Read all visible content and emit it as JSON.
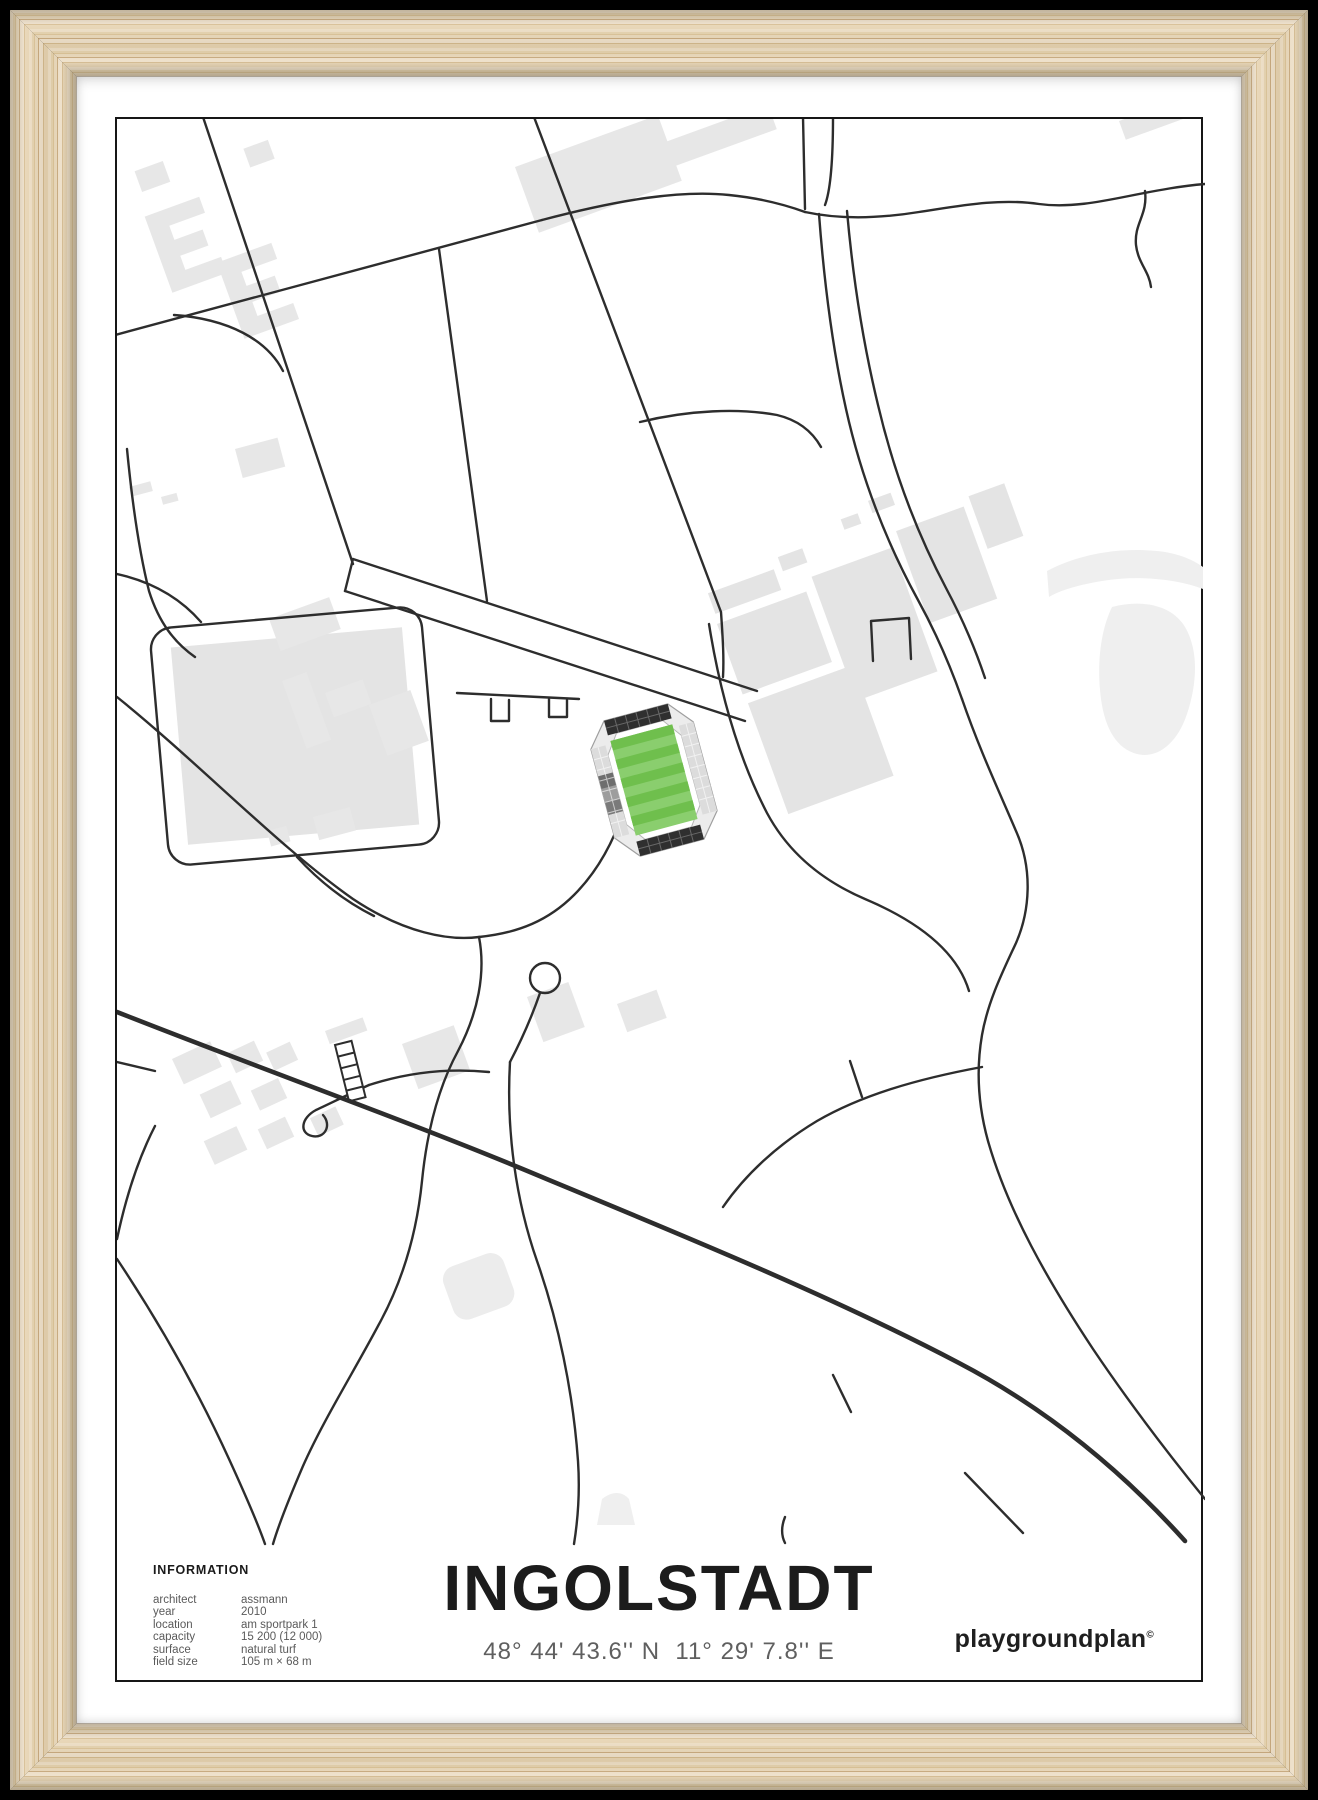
{
  "poster": {
    "title": "INGOLSTADT",
    "coordinates": "48° 44' 43.6'' N  11° 29' 7.8'' E",
    "brand": "playgroundplan",
    "brand_mark": "©",
    "information": {
      "header": "INFORMATION",
      "rows": [
        {
          "label": "architect",
          "value": "assmann"
        },
        {
          "label": "year",
          "value": "2010"
        },
        {
          "label": "location",
          "value": "am sportpark 1"
        },
        {
          "label": "capacity",
          "value": "15 200 (12 000)"
        },
        {
          "label": "surface",
          "value": "natural turf"
        },
        {
          "label": "field size",
          "value": "105 m × 68 m"
        }
      ]
    },
    "colors": {
      "background": "#000000",
      "frame_wood": "#e7d3ae",
      "mat": "#ffffff",
      "map_border": "#161616",
      "road": "#2d2d2d",
      "building": "#e7e7e7",
      "pitch_green": "#6fbf4d",
      "pitch_green_light": "#8ace6e",
      "stand_dark": "#2f2f2f",
      "stand_mid": "#9d9d9d",
      "stand_light": "#dcdcdc"
    }
  }
}
